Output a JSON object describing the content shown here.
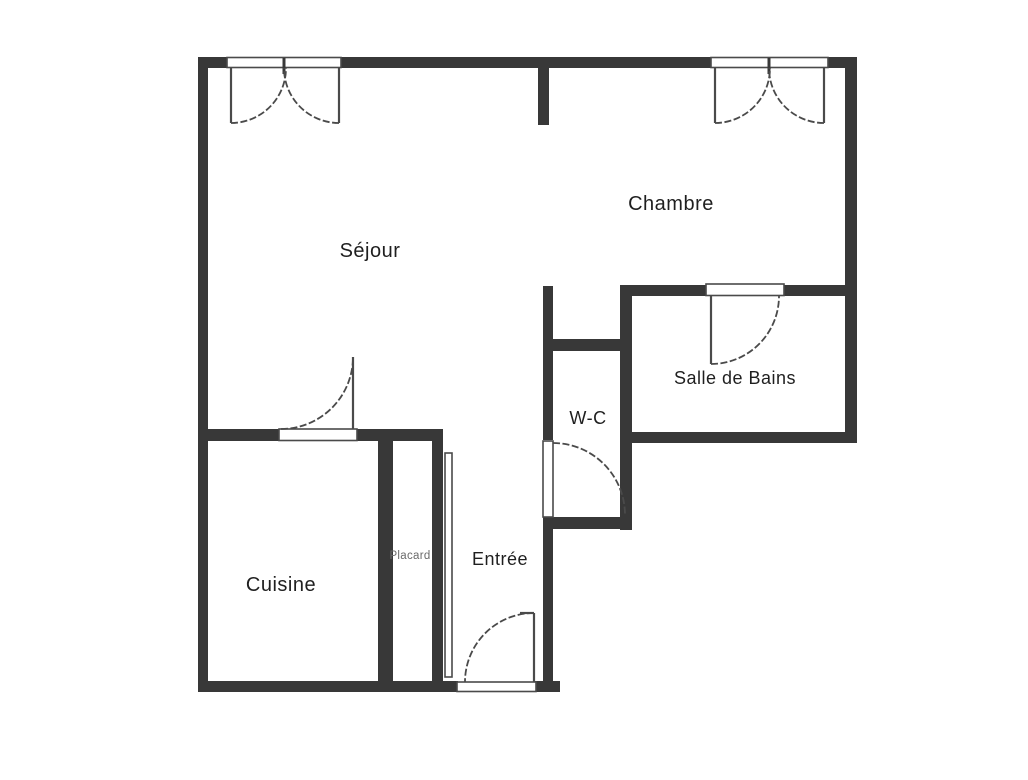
{
  "plan": {
    "type": "floor-plan",
    "language": "fr",
    "colors": {
      "wall": "#383838",
      "line": "#4a4a4a",
      "ink": "#1f1f1f",
      "muted": "#6a6a6a",
      "background": "#ffffff"
    },
    "rooms": [
      {
        "id": "sejour",
        "label": "Séjour"
      },
      {
        "id": "chambre",
        "label": "Chambre"
      },
      {
        "id": "salle-de-bains",
        "label": "Salle de Bains"
      },
      {
        "id": "wc",
        "label": "W-C"
      },
      {
        "id": "entree",
        "label": "Entrée"
      },
      {
        "id": "cuisine",
        "label": "Cuisine"
      },
      {
        "id": "placard",
        "label": "Placard"
      }
    ],
    "features": {
      "windows": [
        {
          "id": "sejour-window",
          "type": "double-casement",
          "location": "top wall, Séjour"
        },
        {
          "id": "chambre-window",
          "type": "double-casement",
          "location": "top wall, Chambre"
        }
      ],
      "doors": [
        {
          "id": "entrance-door",
          "swing": "into Entrée",
          "location": "bottom wall"
        },
        {
          "id": "cuisine-door",
          "swing": "into Séjour",
          "location": "Cuisine top wall"
        },
        {
          "id": "wc-door",
          "swing": "into W-C",
          "location": "W-C left wall"
        },
        {
          "id": "bathroom-door",
          "swing": "into Salle de Bains",
          "location": "Salle de Bains top wall"
        },
        {
          "id": "placard-door",
          "type": "leaf panel",
          "location": "Placard right side"
        }
      ]
    }
  }
}
